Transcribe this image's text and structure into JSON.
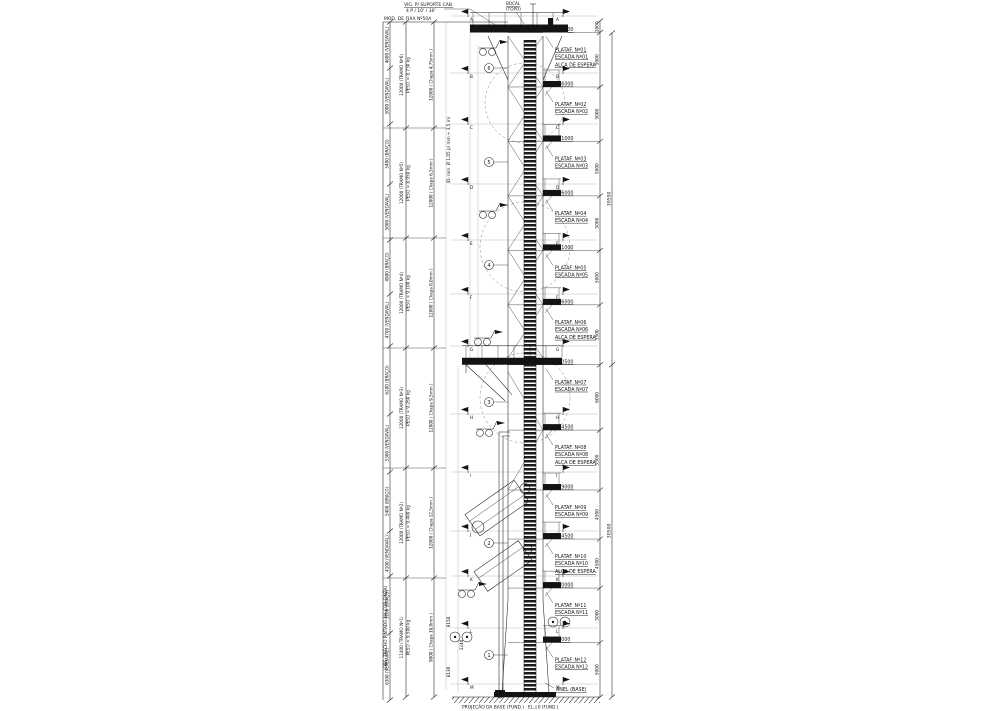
{
  "drawing": {
    "notes": {
      "top_left_header": "MOD. DE FIXA Nº50A",
      "top_note_line1": "VIG. P/ SUPORTE CAB.",
      "top_note_line2": "4 P / 10' / 30'",
      "top_center_line1": "BOCAL",
      "top_center_line2": "(TOPO)",
      "mid_note": "(D- mín. Ø 1,05 p/ mm + 3,5 m)",
      "side_note": "(OBS: TRECHO PINTADO NA COR CINZA)",
      "bottom_note": "PROJEÇÃO DA BASE (FUND.)",
      "base_label": "ANEL (BASE)",
      "base_elev": "EL.±0 (FUND.)"
    },
    "platforms": [
      {
        "el_label": "EL.61000",
        "el_value": 61000,
        "plat": "PLATAF. Nº01",
        "escada": "ESCADA Nº01",
        "espera": "ALÇA DE ESPERA",
        "type": "top"
      },
      {
        "el_label": "EL.56000",
        "el_value": 56000,
        "plat": "PLATAF. Nº02",
        "escada": "ESCADA Nº02",
        "espera": null,
        "type": "std"
      },
      {
        "el_label": "EL.51000",
        "el_value": 51000,
        "plat": "PLATAF. Nº03",
        "escada": "ESCADA Nº03",
        "espera": null,
        "type": "std"
      },
      {
        "el_label": "EL.46000",
        "el_value": 46000,
        "plat": "PLATAF. Nº04",
        "escada": "ESCADA Nº04",
        "espera": null,
        "type": "std"
      },
      {
        "el_label": "EL.41000",
        "el_value": 41000,
        "plat": "PLATAF. Nº05",
        "escada": "ESCADA Nº05",
        "espera": null,
        "type": "std"
      },
      {
        "el_label": "EL.36000",
        "el_value": 36000,
        "plat": "PLATAF. Nº06",
        "escada": "ESCADA Nº06",
        "espera": "ALÇA DE ESPERA",
        "type": "std"
      },
      {
        "el_label": "EL.30500",
        "el_value": 30500,
        "plat": "PLATAF. Nº07",
        "escada": "ESCADA Nº07",
        "espera": null,
        "type": "bracket"
      },
      {
        "el_label": "EL.24500",
        "el_value": 24500,
        "plat": "PLATAF. Nº08",
        "escada": "ESCADA Nº08",
        "espera": "ALÇA DE ESPERA",
        "type": "std"
      },
      {
        "el_label": "EL.19000",
        "el_value": 19000,
        "plat": "PLATAF. Nº09",
        "escada": "ESCADA Nº09",
        "espera": null,
        "type": "std"
      },
      {
        "el_label": "EL.14500",
        "el_value": 14500,
        "plat": "PLATAF. Nº10",
        "escada": "ESCADA Nº10",
        "espera": "ALÇA DE ESPERA",
        "type": "std"
      },
      {
        "el_label": "EL.10000",
        "el_value": 10000,
        "plat": "PLATAF. Nº11",
        "escada": "ESCADA Nº11",
        "espera": null,
        "type": "std"
      },
      {
        "el_label": "EL.5000",
        "el_value": 5000,
        "plat": "PLATAF. Nº12",
        "escada": "ESCADA Nº12",
        "espera": null,
        "type": "std"
      }
    ],
    "right_dims": [
      "2000",
      "5000",
      "5000",
      "5000",
      "5000",
      "5000",
      "5500",
      "6000",
      "5500",
      "4500",
      "4500",
      "5000",
      "5000"
    ],
    "right_dims2": [
      "30500",
      "30500"
    ],
    "flags": [
      {
        "letter": "A",
        "y": 16
      },
      {
        "letter": "B",
        "y": 73
      },
      {
        "letter": "C",
        "y": 124
      },
      {
        "letter": "D",
        "y": 184
      },
      {
        "letter": "E",
        "y": 240
      },
      {
        "letter": "F",
        "y": 294
      },
      {
        "letter": "G",
        "y": 346
      },
      {
        "letter": "H",
        "y": 414
      },
      {
        "letter": "I",
        "y": 472
      },
      {
        "letter": "J",
        "y": 531
      },
      {
        "letter": "K",
        "y": 576
      },
      {
        "letter": "L",
        "y": 628
      },
      {
        "letter": "M",
        "y": 684
      }
    ],
    "detail_circles": [
      {
        "n": "6",
        "y": 68
      },
      {
        "n": "5",
        "y": 162
      },
      {
        "n": "4",
        "y": 265
      },
      {
        "n": "3",
        "y": 402
      },
      {
        "n": "2",
        "y": 543
      },
      {
        "n": "1",
        "y": 655
      }
    ],
    "hoist_icons": [
      {
        "x": 483,
        "y": 52
      },
      {
        "x": 483,
        "y": 215
      },
      {
        "x": 478,
        "y": 342
      },
      {
        "x": 480,
        "y": 433
      },
      {
        "x": 462,
        "y": 594
      }
    ],
    "left_chain1": [
      "4600 (VENDAVAL)",
      "5000 (VENDAVAL)",
      "5400 (BRAÇO)",
      "5000 (VENDAVAL)",
      "4900 (BRAÇO)",
      "4700 (VENDAVAL)",
      "6200 (BRAÇO)",
      "5300 (VENDAVAL)",
      "5400 (BRAÇO)",
      "4100 (VENDAVAL)",
      "5200 (BRAÇO)",
      "6300 (VENDAVAL)"
    ],
    "left_chain2": [
      {
        "l1": "12000 (TRAMO Nº6)",
        "l2": "PESO ≈ 8.730 kg"
      },
      {
        "l1": "12000 (TRAMO Nº5)",
        "l2": "PESO ≈ 8.950 kg"
      },
      {
        "l1": "12000 (TRAMO Nº4)",
        "l2": "PESO ≈ 9.100 kg"
      },
      {
        "l1": "12000 (TRAMO Nº3)",
        "l2": "PESO ≈ 9.260 kg"
      },
      {
        "l1": "12000 (TRAMO Nº2)",
        "l2": "PESO ≈ 9.400 kg"
      },
      {
        "l1": "11400 (TRAMO Nº1)",
        "l2": "PESO ≈ 9.500 kg"
      }
    ],
    "left_chain3": [
      "12000 ( Chapa 4,75mm )",
      "12000 ( Chapa 6,3mm )",
      "12000 ( Chapa 8,0mm )",
      "12000 ( Chapa 9,5mm )",
      "12000 ( Chapa 12,5mm )",
      "9000 ( Chapa 16,0mm )"
    ],
    "inner_dims": [
      {
        "t": "6150",
        "x": 450,
        "y": 622
      },
      {
        "t": "8130",
        "x": 450,
        "y": 672
      },
      {
        "t": "1240",
        "x": 463,
        "y": 645
      }
    ]
  }
}
